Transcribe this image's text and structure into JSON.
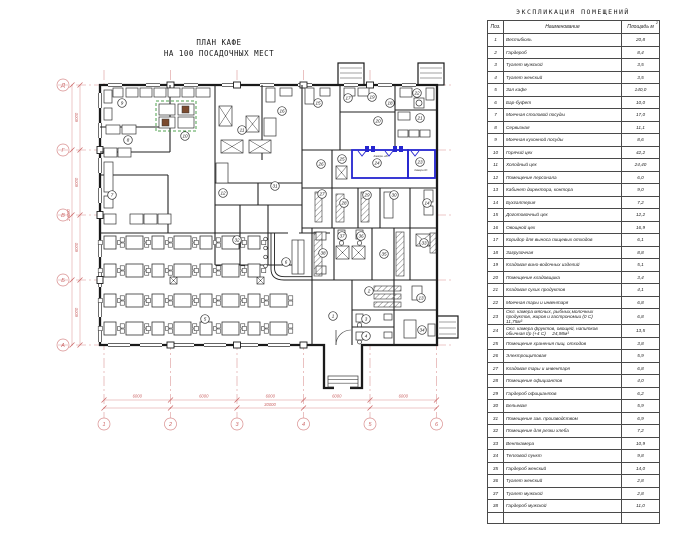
{
  "plan": {
    "title_line1": "ПЛАН КАФЕ",
    "title_line2": "НА 100 ПОСАДОЧНЫХ МЕСТ",
    "axes_horizontal": [
      "1",
      "2",
      "3",
      "4",
      "5",
      "6"
    ],
    "axes_vertical_bottom_to_top": [
      "А",
      "Б",
      "В",
      "Г",
      "Д"
    ],
    "dims_bottom": [
      "6000",
      "6000",
      "6000",
      "6000",
      "6000"
    ],
    "dim_bottom_total": "30000",
    "dims_left": [
      "6000",
      "6000",
      "6000",
      "6000"
    ],
    "dim_left_total": "24000",
    "highlight_room_labels": {
      "room24": "Камера +4С",
      "room23": "Камера 0С"
    },
    "colors": {
      "walls": "#1a1a1a",
      "grid_red": "#d98f8f",
      "highlight_blue": "#2525cf",
      "island_green": "#4ea04e"
    },
    "room_markers": [
      {
        "n": "1",
        "x": 333,
        "y": 316
      },
      {
        "n": "2",
        "x": 369,
        "y": 291
      },
      {
        "n": "3",
        "x": 366,
        "y": 319
      },
      {
        "n": "4",
        "x": 366,
        "y": 336
      },
      {
        "n": "5",
        "x": 205,
        "y": 319
      },
      {
        "n": "6",
        "x": 286,
        "y": 262
      },
      {
        "n": "7",
        "x": 112,
        "y": 195
      },
      {
        "n": "8",
        "x": 128,
        "y": 140
      },
      {
        "n": "9",
        "x": 122,
        "y": 103
      },
      {
        "n": "10",
        "x": 185,
        "y": 136
      },
      {
        "n": "11",
        "x": 242,
        "y": 130
      },
      {
        "n": "12",
        "x": 223,
        "y": 193
      },
      {
        "n": "13",
        "x": 421,
        "y": 298
      },
      {
        "n": "14",
        "x": 427,
        "y": 203
      },
      {
        "n": "15",
        "x": 318,
        "y": 103
      },
      {
        "n": "16",
        "x": 282,
        "y": 111
      },
      {
        "n": "17",
        "x": 348,
        "y": 98
      },
      {
        "n": "18",
        "x": 390,
        "y": 103
      },
      {
        "n": "19",
        "x": 372,
        "y": 97
      },
      {
        "n": "20",
        "x": 378,
        "y": 121
      },
      {
        "n": "21",
        "x": 420,
        "y": 118
      },
      {
        "n": "22",
        "x": 417,
        "y": 93
      },
      {
        "n": "23",
        "x": 420,
        "y": 162
      },
      {
        "n": "24",
        "x": 377,
        "y": 163
      },
      {
        "n": "25",
        "x": 342,
        "y": 159
      },
      {
        "n": "26",
        "x": 321,
        "y": 164
      },
      {
        "n": "27",
        "x": 322,
        "y": 194
      },
      {
        "n": "28",
        "x": 344,
        "y": 203
      },
      {
        "n": "29",
        "x": 367,
        "y": 195
      },
      {
        "n": "30",
        "x": 394,
        "y": 195
      },
      {
        "n": "31",
        "x": 275,
        "y": 186
      },
      {
        "n": "32",
        "x": 237,
        "y": 240
      },
      {
        "n": "33",
        "x": 424,
        "y": 243
      },
      {
        "n": "34",
        "x": 422,
        "y": 330
      },
      {
        "n": "35",
        "x": 384,
        "y": 254
      },
      {
        "n": "36",
        "x": 361,
        "y": 236
      },
      {
        "n": "37",
        "x": 342,
        "y": 236
      },
      {
        "n": "38",
        "x": 323,
        "y": 253
      }
    ]
  },
  "table": {
    "title": "ЭКСПЛИКАЦИЯ ПОМЕЩЕНИЙ",
    "col_pos": "Поз.",
    "col_name": "Наименование",
    "col_area": "Площадь м",
    "col_area_sup": "2",
    "rows": [
      [
        "1",
        "Вестибюль",
        "20,8"
      ],
      [
        "2",
        "Гардероб",
        "8,4"
      ],
      [
        "3",
        "Туалет мужской",
        "3,5"
      ],
      [
        "4",
        "Туалет женский",
        "3,5"
      ],
      [
        "5",
        "Зал кафе",
        "140,0"
      ],
      [
        "6",
        "Бар-буфет",
        "10,0"
      ],
      [
        "7",
        "Моечная столовой посуды",
        "17,0"
      ],
      [
        "8",
        "Сервизная",
        "11,1"
      ],
      [
        "9",
        "Моечная кухонной посуды",
        "8,6"
      ],
      [
        "10",
        "Горячий цех",
        "42,2"
      ],
      [
        "11",
        "Холодный цех",
        "24,40"
      ],
      [
        "12",
        "Помещение персонала",
        "6,0"
      ],
      [
        "13",
        "Кабинет директора, контора",
        "9,0"
      ],
      [
        "14",
        "Бухгалтерия",
        "7,2"
      ],
      [
        "15",
        "Доготовочный цех",
        "12,2"
      ],
      [
        "16",
        "Овощной цех",
        "16,9"
      ],
      [
        "17",
        "Коридор для выноса пищевых отходов",
        "6,1"
      ],
      [
        "18",
        "Загрузочная",
        "8,8"
      ],
      [
        "19",
        "Кладовая вино-водочных изделий",
        "5,1"
      ],
      [
        "20",
        "Помещение кладовщика",
        "3,4"
      ],
      [
        "21",
        "Кладовая сухих продуктов",
        "4,1"
      ],
      [
        "22",
        "Моечная тары и инвентаря",
        "6,8"
      ],
      [
        "23",
        "Охл. камера мясных, рыбных,молочных\nпродуктов, жиров и гастрономии (0 С)\n11,75м³",
        "6,8"
      ],
      [
        "24",
        "Охл. камера фруктов, овощей, напитков\nобычная t/р (+4 С)     24,98м³",
        "13,5"
      ],
      [
        "25",
        "Помещение хранения пищ. отходов",
        "3,8"
      ],
      [
        "26",
        "Электрощитовая",
        "5,9"
      ],
      [
        "27",
        "Кладовая тары и инвентаря",
        "6,8"
      ],
      [
        "28",
        "Помещение официантов",
        "4,0"
      ],
      [
        "29",
        "Гардероб официантов",
        "6,2"
      ],
      [
        "30",
        "Бельевая",
        "5,9"
      ],
      [
        "31",
        "Помещение зав. производством",
        "6,9"
      ],
      [
        "32",
        "Помещение для резки хлеба",
        "7,2"
      ],
      [
        "33",
        "Венткамера",
        "10,9"
      ],
      [
        "34",
        "Тепловой пункт",
        "9,8"
      ],
      [
        "35",
        "Гардероб женский",
        "14,0"
      ],
      [
        "36",
        "Туалет женский",
        "2,8"
      ],
      [
        "37",
        "Туалет мужской",
        "2,8"
      ],
      [
        "38",
        "Гардероб мужской",
        "11,0"
      ]
    ]
  }
}
